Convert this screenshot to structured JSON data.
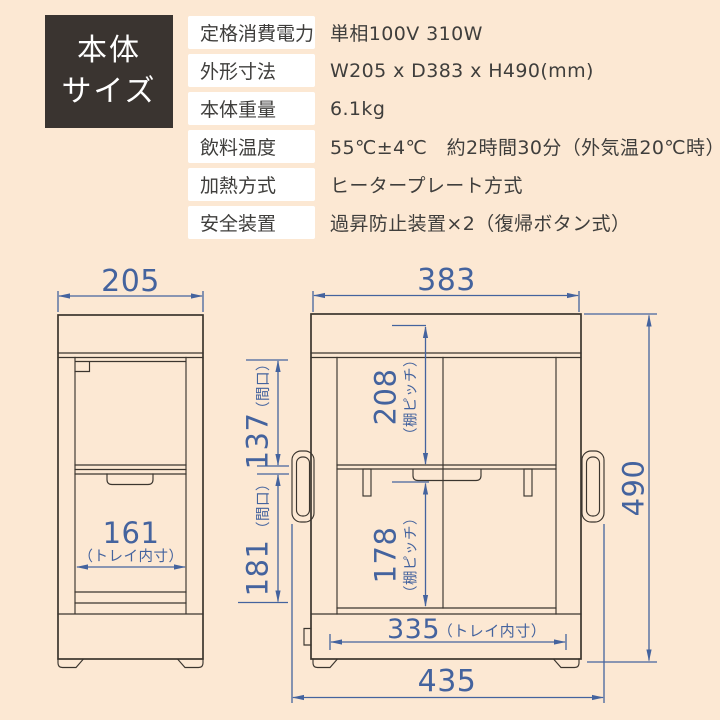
{
  "colors": {
    "background": "#fce8d3",
    "dimension_blue": "#44639e",
    "drawing_line": "#3b352e",
    "title_box_bg": "#3a3430",
    "label_bg": "#ffffff",
    "text": "#3f3e3c"
  },
  "header": {
    "title_line1": "本体",
    "title_line2": "サイズ"
  },
  "spec_table": {
    "rows": [
      {
        "label": "定格消費電力",
        "value": "単相100V 310W"
      },
      {
        "label": "外形寸法",
        "value": "W205 x D383 x H490(mm)"
      },
      {
        "label": "本体重量",
        "value": "6.1kg"
      },
      {
        "label": "飲料温度",
        "value": "55℃±4℃　約2時間30分（外気温20℃時）"
      },
      {
        "label": "加熱方式",
        "value": "ヒータープレート方式"
      },
      {
        "label": "安全装置",
        "value": "過昇防止装置×2（復帰ボタン式）"
      }
    ]
  },
  "diagram": {
    "front_view": {
      "width": "205",
      "tray_width": "161",
      "tray_width_note": "（トレイ内寸）",
      "upper_opening": "137",
      "upper_opening_note": "（間口）",
      "lower_opening": "181",
      "lower_opening_note": "（間口）"
    },
    "side_view": {
      "depth": "383",
      "upper_shelf_pitch": "208",
      "upper_shelf_pitch_note": "（棚ピッチ）",
      "lower_shelf_pitch": "178",
      "lower_shelf_pitch_note": "（棚ピッチ）",
      "tray_depth": "335",
      "tray_depth_note": "（トレイ内寸）",
      "overall_depth": "435",
      "height": "490"
    }
  }
}
